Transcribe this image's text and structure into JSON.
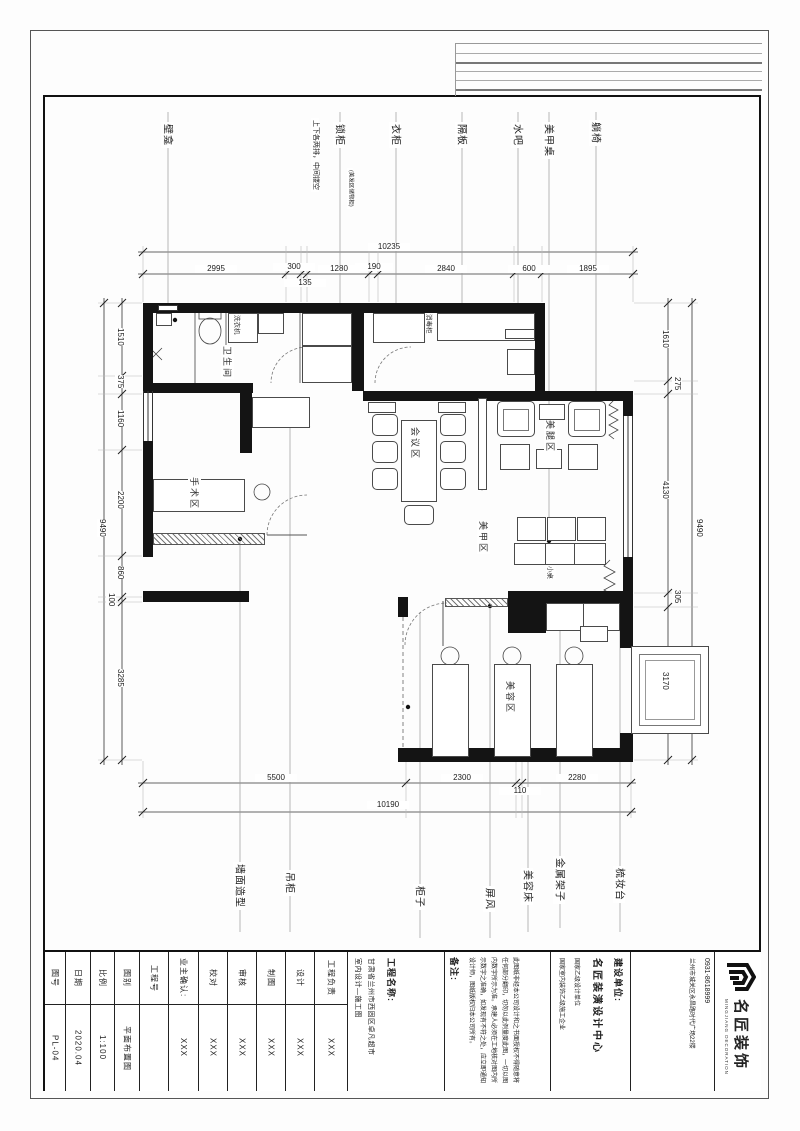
{
  "dims": {
    "top": {
      "overall": "10235",
      "segments": [
        "2995",
        "300",
        "135",
        "1280",
        "190",
        "2840",
        "600",
        "1895"
      ]
    },
    "bottom": {
      "overall": "10190",
      "segments": [
        "5500",
        "2300",
        "110",
        "2280"
      ]
    },
    "left": {
      "overall": "9490",
      "segments": [
        "1510",
        "375",
        "1160",
        "2200",
        "860",
        "100",
        "3285"
      ]
    },
    "right": {
      "overall": "9490",
      "segments": [
        "1610",
        "275",
        "4130",
        "305",
        "3170"
      ]
    }
  },
  "plan": {
    "top_labels": {
      "niche": "壁龛",
      "note": "上下各两排，中间镂空",
      "locker": "锁柜",
      "locker_note": "(美发区储物柜)",
      "wardrobe": "衣柜",
      "shelf": "隔板",
      "water_bar": "水吧",
      "nail_table": "美甲桌",
      "lounge_chair": "躺椅"
    },
    "bottom_labels": {
      "wall_feature": "墙面造型",
      "hanging_cabinet": "吊柜",
      "cabinet": "柜子",
      "screen": "屏风",
      "beauty_bed": "美容床",
      "metal_rack": "金属架子",
      "dressing_table": "梳妆台"
    },
    "rooms": {
      "bathroom": "卫生间",
      "meeting": "会议区",
      "leg_area": "美腿区",
      "nail_area": "美甲区",
      "surgery": "手术区",
      "beauty": "美容区"
    },
    "fixtures": {
      "washer": "洗衣机",
      "sterilizer": "消毒柜",
      "small_table": "小桌"
    }
  },
  "title_block": {
    "fields": [
      {
        "label": "图号",
        "value": "PL-04"
      },
      {
        "label": "日期",
        "value": "2020.04"
      },
      {
        "label": "比例",
        "value": "1:100"
      },
      {
        "label": "图别",
        "value": "平面布置图"
      },
      {
        "label": "工程号",
        "value": ""
      }
    ],
    "owner": {
      "label": "业主确认:",
      "value": "XXX"
    },
    "personnel": [
      {
        "label": "校对",
        "value": "XXX"
      },
      {
        "label": "审核",
        "value": "XXX"
      },
      {
        "label": "制图",
        "value": "XXX"
      },
      {
        "label": "设计",
        "value": "XXX"
      },
      {
        "label": "工程负责",
        "value": "XXX"
      }
    ],
    "project": {
      "label": "工程名称:",
      "line1": "甘肃省兰州市西固区卓凡超市",
      "line2": "室内设计—施工图"
    },
    "notes": {
      "label": "备注:",
      "text": "此图纸非经本公司设计和之书面授权不得随意将任何部分翻印，切勿以此例量度此图，一切以图内数字所示为准。承建人必须在工地核对图内所示数字之准确，如发现有不符之处，应立即通知设计师，图纸版权归本公司所有。"
    },
    "client": {
      "label": "建设单位:",
      "name": "名匠装潢设计中心",
      "cert1": "国家乙级设计单位",
      "cert2": "国家室内装饰乙级施工企业"
    },
    "contact": {
      "address": "兰州市城关区永昌路时代广场22楼",
      "phone": "0931-8618999"
    },
    "logo": {
      "name": "名匠装饰",
      "caption": "MINGJIANG DECORATION"
    }
  }
}
